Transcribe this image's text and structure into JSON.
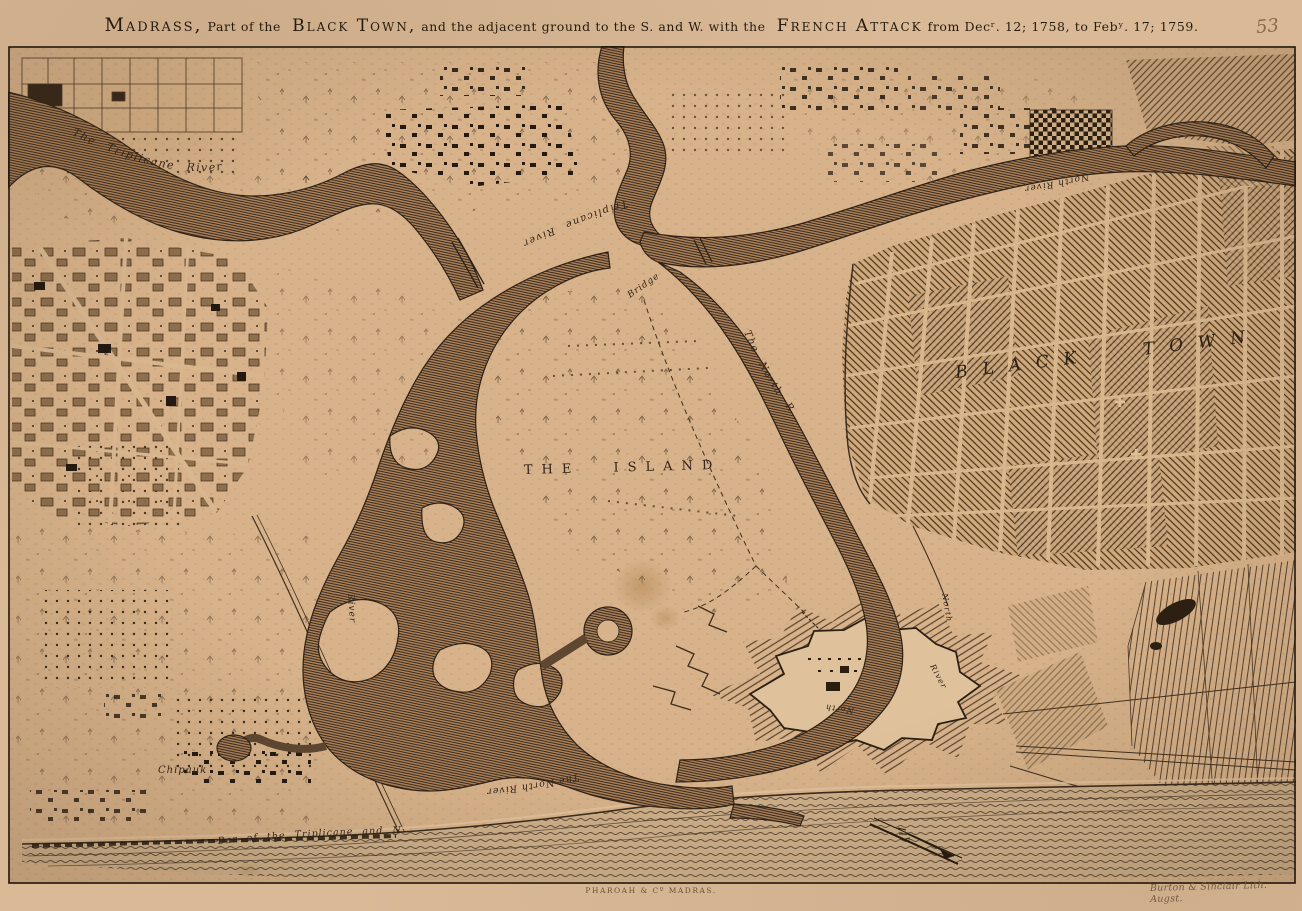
{
  "page": {
    "plate_number": "53",
    "imprint_center": "PHAROAH & Cº MADRAS.",
    "imprint_right": "Burton & Sinclair Lith. Augst."
  },
  "title": {
    "part1": "Madrass,",
    "part2": "Part of the",
    "part3": "Black Town,",
    "part4": "and the adjacent ground to the S. and W. with the",
    "part5": "French Attack",
    "part6": "from Decʳ. 12; 1758, to Febʸ. 17; 1759."
  },
  "labels": {
    "triplicane_river_upper": "The Triplicane River",
    "triplicane_river_mid": "Triplicane River",
    "north_river_upper": "North River",
    "north_river_mid": "The North River",
    "north_river_lower": "The North River",
    "the_island": "THE ISLAND",
    "black_town": "BLACK TOWN",
    "chipauk": "Chipauk",
    "bar": "Bar of the Triplicane and North River",
    "bridge": "Bridge",
    "fort_channel_north": "North",
    "fort_channel_river": "River",
    "west_river": "River"
  }
}
